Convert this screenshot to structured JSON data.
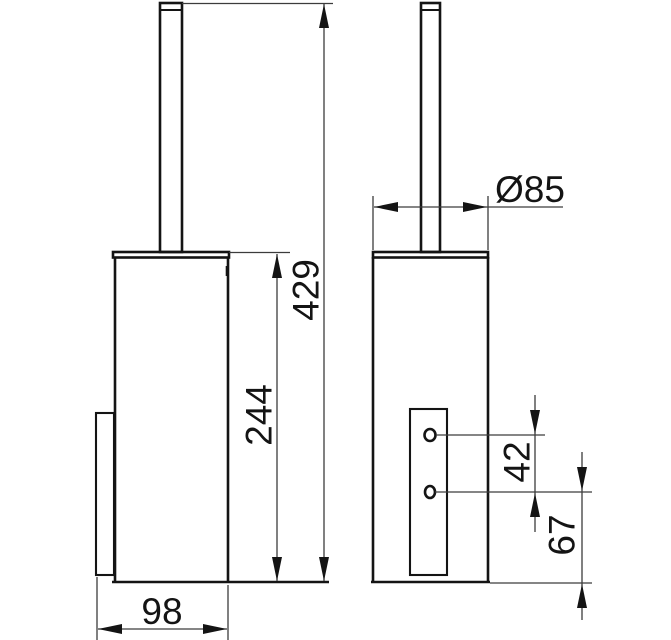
{
  "drawing": {
    "type": "technical-dimension-drawing",
    "subject": "wall-mounted toilet brush set, front and side views",
    "views": {
      "front": "front-view",
      "side": "side-view"
    },
    "colors": {
      "background": "#ffffff",
      "object_line": "#141414",
      "dimension_line": "#3c3c3c"
    }
  },
  "dimensions": {
    "overall_height": "429",
    "container_height": "244",
    "depth": "98",
    "diameter": "Ø85",
    "hole_spacing": "42",
    "hole_to_bottom": "67"
  }
}
